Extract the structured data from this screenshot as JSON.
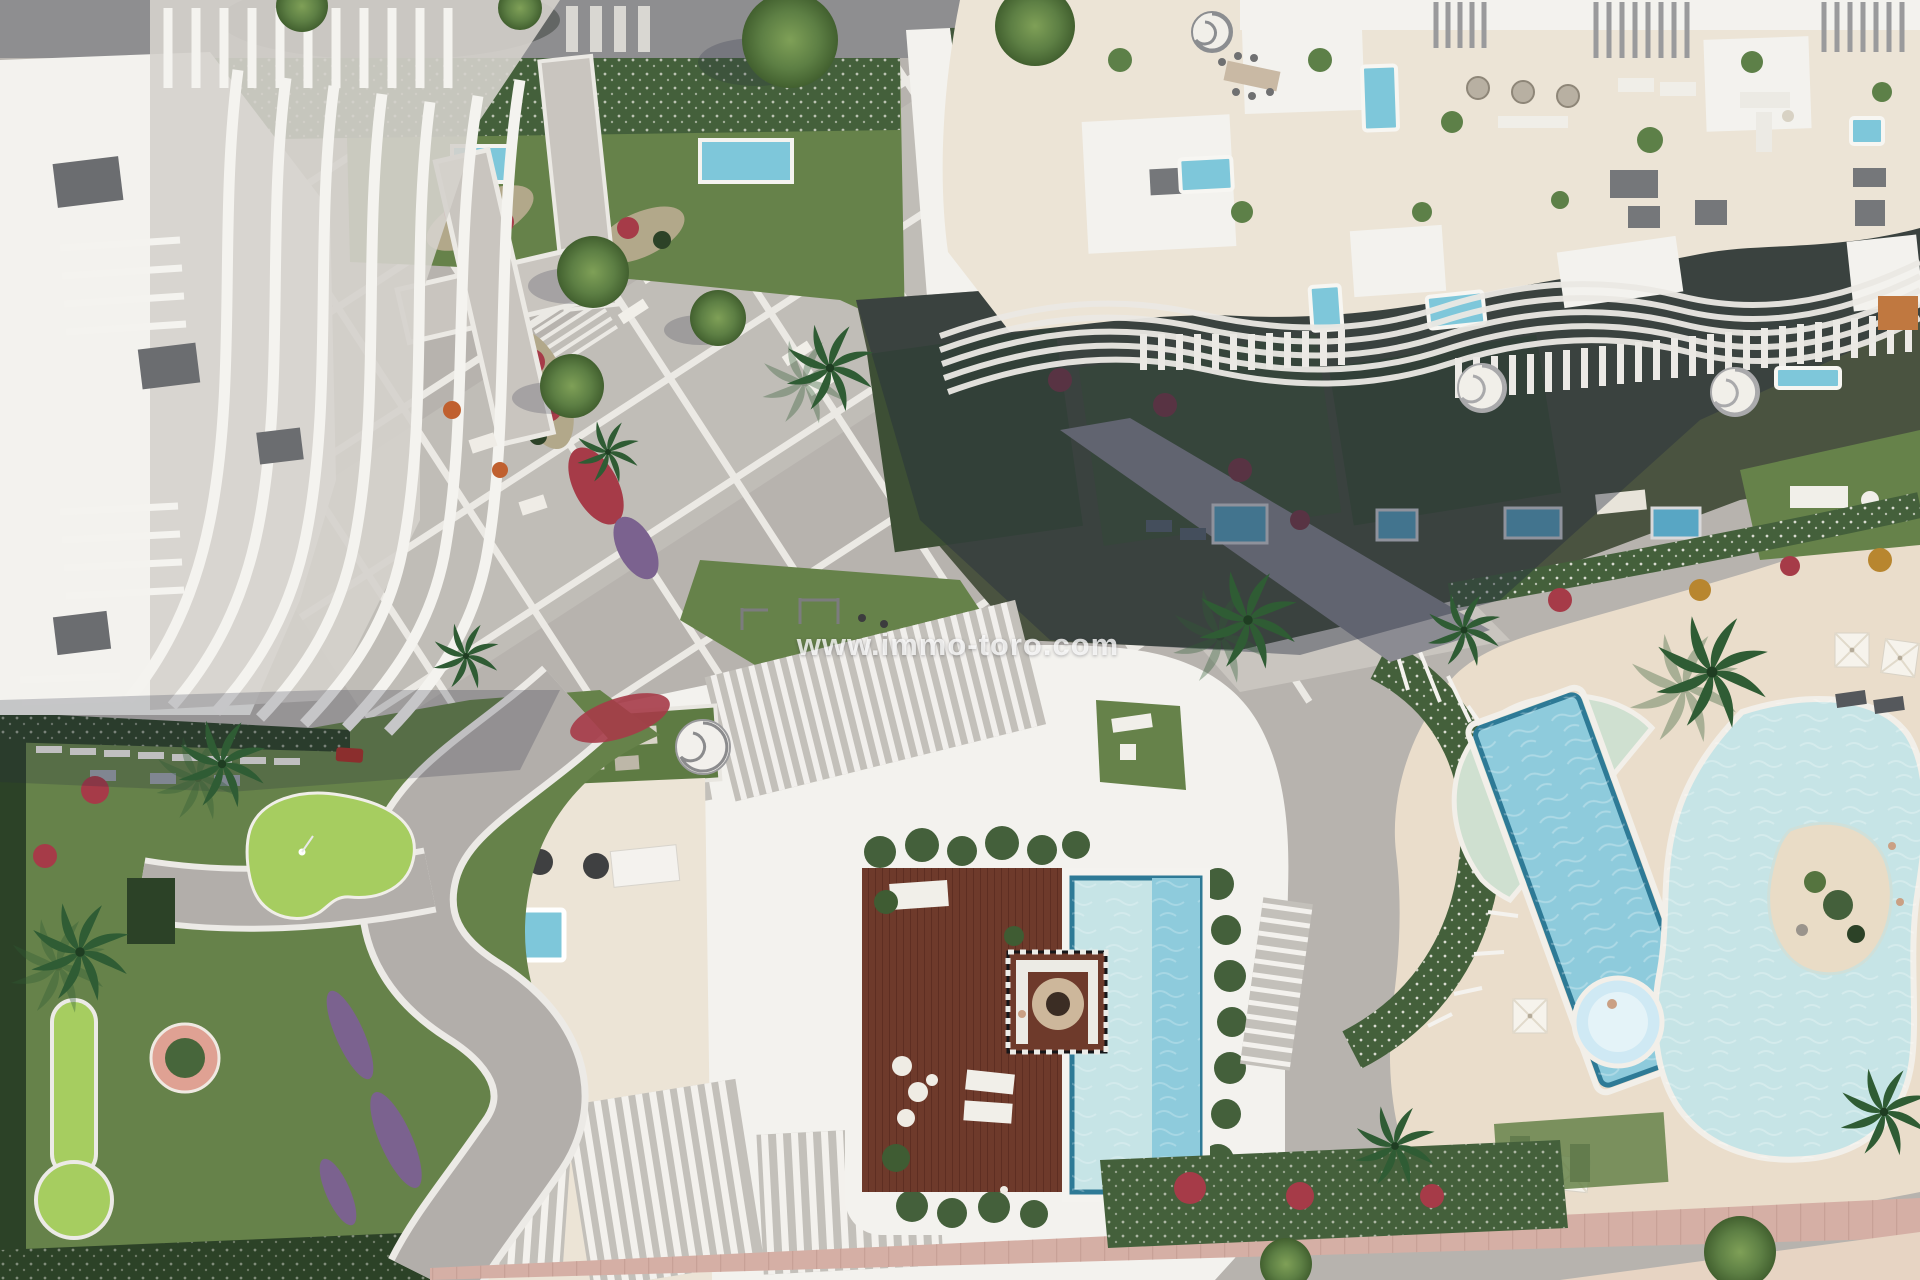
{
  "watermark": {
    "text": "www.immo-toro.com"
  },
  "palette": {
    "road": "#8e8e90",
    "pavement": "#b7b3ae",
    "pavement-light": "#c9c5bf",
    "joint": "#ebe9e4",
    "building-white": "#f3f2ee",
    "building-shade": "#d5d2cc",
    "slat-gap": "#c3c0ba",
    "terrace-cream": "#ece4d6",
    "lawn": "#66824a",
    "lawn-bright": "#a6cd60",
    "lawn-dark": "#41563a",
    "hedge": "#44603b",
    "hedge-dark": "#2c4227",
    "flower-red": "#a63b48",
    "flower-purple": "#7b628f",
    "flower-khaki": "#b2a88a",
    "tree-green": "#55743f",
    "palm-green": "#2f5c34",
    "pool-blue": "#7ec7da",
    "pool-pale": "#c6e4e6",
    "pool-rim": "#2e7a96",
    "pool-lane": "#8ecbdc",
    "pool-d": "#cfe0d0",
    "jacuzzi": "#cfe9f4",
    "wood-deck": "#6e3a2b",
    "wood-dark": "#4f241a",
    "sand": "#eaddcb",
    "sand-beach": "#e7d4c3",
    "promenade": "#d5afa5",
    "umbrella": "#f6f3ec",
    "furniture-dark": "#55585c",
    "shadow": "rgba(36,42,62,0.40)",
    "shadow-soft": "rgba(36,42,62,0.22)",
    "watermark": "rgba(255,255,255,0.78)"
  },
  "scene": {
    "type": "aerial-3d-render",
    "regions": [
      {
        "name": "top-road"
      },
      {
        "name": "top-left-curved-fin-building"
      },
      {
        "name": "top-lawn-with-plunge-pools"
      },
      {
        "name": "top-right-terrace-building"
      },
      {
        "name": "shaded-ground-gardens"
      },
      {
        "name": "central-diagonal-plaza"
      },
      {
        "name": "bottom-center-building-with-roof-deck"
      },
      {
        "name": "rooftop-wood-deck-lap-pool"
      },
      {
        "name": "mini-golf-garden"
      },
      {
        "name": "freeform-pool-complex"
      },
      {
        "name": "beach-promenade"
      }
    ]
  }
}
